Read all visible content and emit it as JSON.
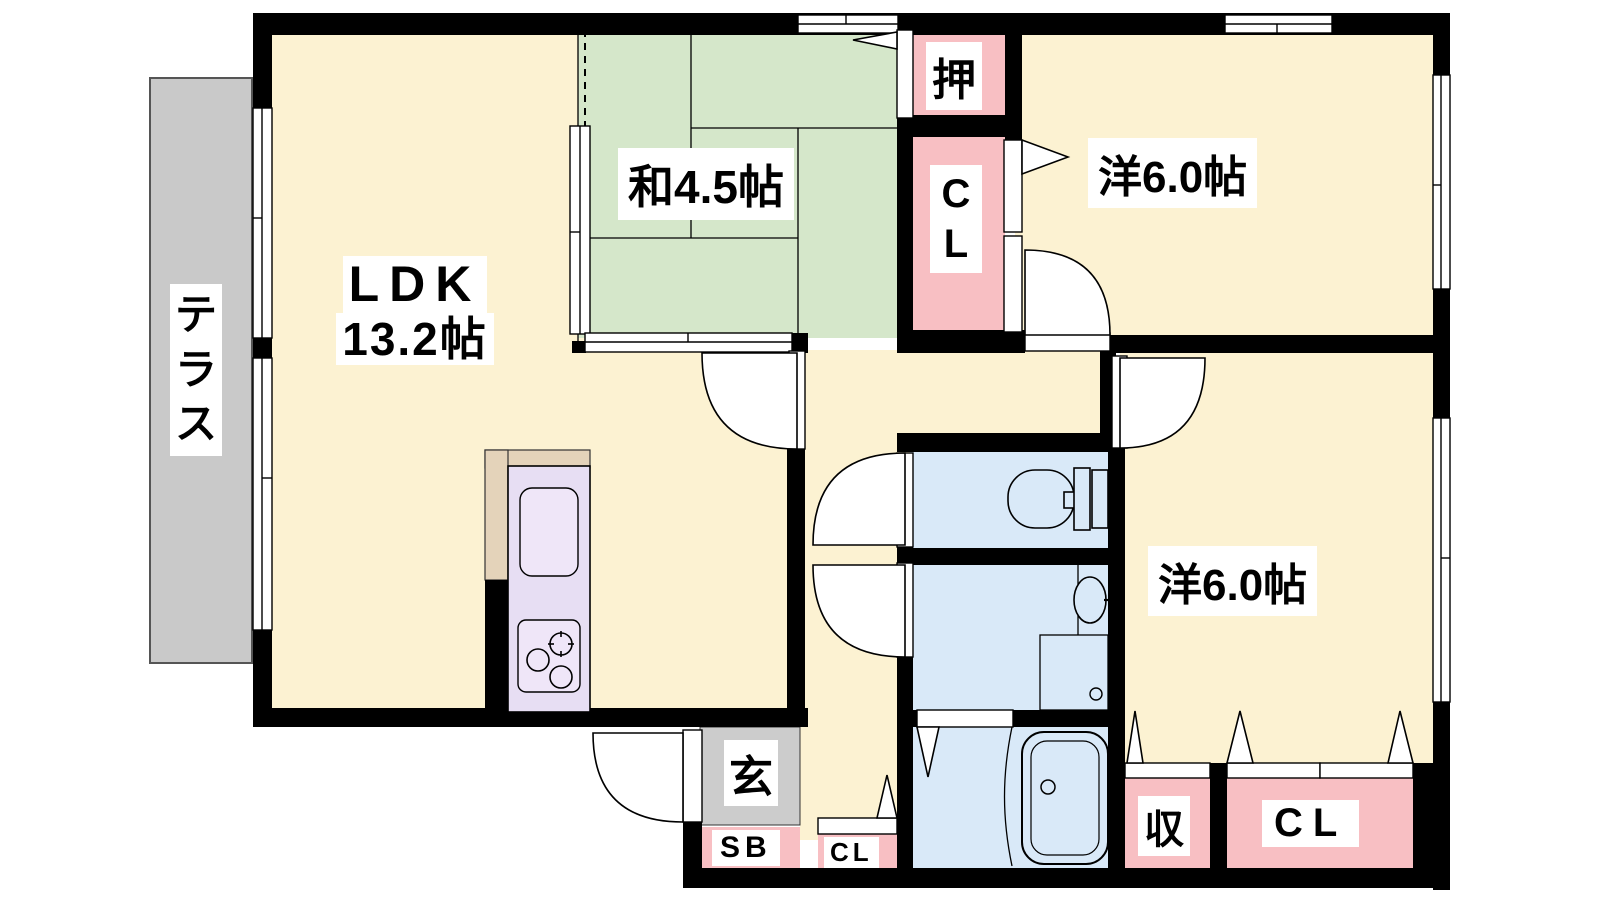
{
  "plan": {
    "title": "2LDK apartment floor plan",
    "ldk": {
      "name": "LDK",
      "area": "13.2帖"
    },
    "washitsu": {
      "label": "和4.5帖"
    },
    "western_top": {
      "label": "洋6.0帖"
    },
    "western_right": {
      "label": "洋6.0帖"
    },
    "terrace": {
      "label": "テラス"
    },
    "entrance": {
      "label": "玄"
    },
    "shoe_box": {
      "label": "SB"
    },
    "oshiire": {
      "label": "押"
    },
    "closet_upper": {
      "label": "CL"
    },
    "closet_hall": {
      "label": "CL"
    },
    "closet_right": {
      "label": "CL"
    },
    "storage": {
      "label": "収"
    },
    "colors": {
      "room_cream": "#fcf2d2",
      "tatami_green": "#d5e7ca",
      "closet_pink": "#f8bfc3",
      "water_blue": "#d9e9f8",
      "kitchen_lavender": "#e7def3",
      "kitchen_counter_tan": "#e4d3ba",
      "terrace_gray": "#c9c9c9",
      "entrance_gray": "#cccccc",
      "wall_black": "#000000"
    }
  }
}
